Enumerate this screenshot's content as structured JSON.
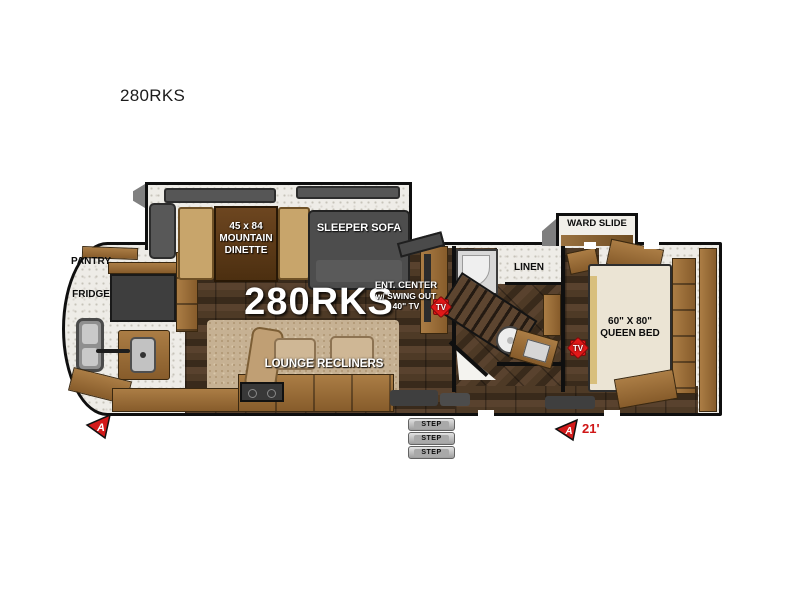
{
  "window": {
    "title": "280RKS"
  },
  "colors": {
    "outline": "#0f0f0f",
    "wood_cabinet": "#9a6f3a",
    "dark_wood_floor": "#42301f",
    "carpet": "#c6b193",
    "furniture_gray": "#4f4f4f",
    "marker_red": "#d31a1a"
  },
  "floorplan": {
    "model": "280RKS",
    "kitchen": {
      "pantry": "PANTRY",
      "fridge": "FRIDGE"
    },
    "dinette": {
      "line1": "45 x 84",
      "line2": "MOUNTAIN",
      "line3": "DINETTE"
    },
    "sofa": "SLEEPER SOFA",
    "ent_center": {
      "line1": "ENT. CENTER",
      "line2": "w/ SWING OUT",
      "line3": "40\" TV"
    },
    "lounge": "LOUNGE RECLINERS",
    "bathroom": {
      "linen": "LINEN"
    },
    "ward_slide": "WARD SLIDE",
    "bedroom": {
      "bed_size": "60\" X 80\"",
      "bed_type": "QUEEN BED"
    },
    "tv_badge": "TV",
    "marker_letter": "A",
    "length": "21'",
    "steps": [
      "STEP",
      "STEP",
      "STEP"
    ]
  }
}
